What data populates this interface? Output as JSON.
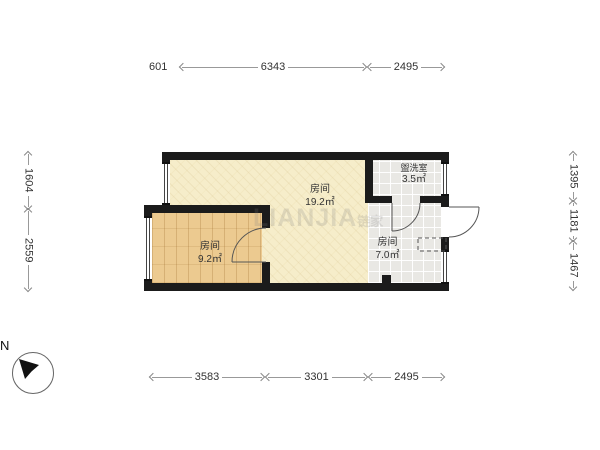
{
  "plan": {
    "rooms": [
      {
        "name": "房间",
        "area": "19.2㎡"
      },
      {
        "name": "房间",
        "area": "9.2㎡"
      },
      {
        "name": "房间",
        "area": "7.0㎡"
      },
      {
        "name": "盥洗室",
        "area": "3.5㎡"
      }
    ],
    "watermark": "LIANJIA",
    "watermark_cjk": "链家"
  },
  "dimensions": {
    "top": [
      "601",
      "6343",
      "2495"
    ],
    "left": [
      "1604",
      "2559"
    ],
    "right": [
      "1395",
      "1181",
      "1467"
    ],
    "bottom": [
      "3583",
      "3301",
      "2495"
    ]
  },
  "compass": {
    "label": "N"
  },
  "colors": {
    "wall": "#1b1b1b",
    "floor_main": "#f6edca",
    "floor_wood": "#ecca90",
    "floor_tile": "#e9e8e4",
    "dimension_text": "#333333"
  }
}
